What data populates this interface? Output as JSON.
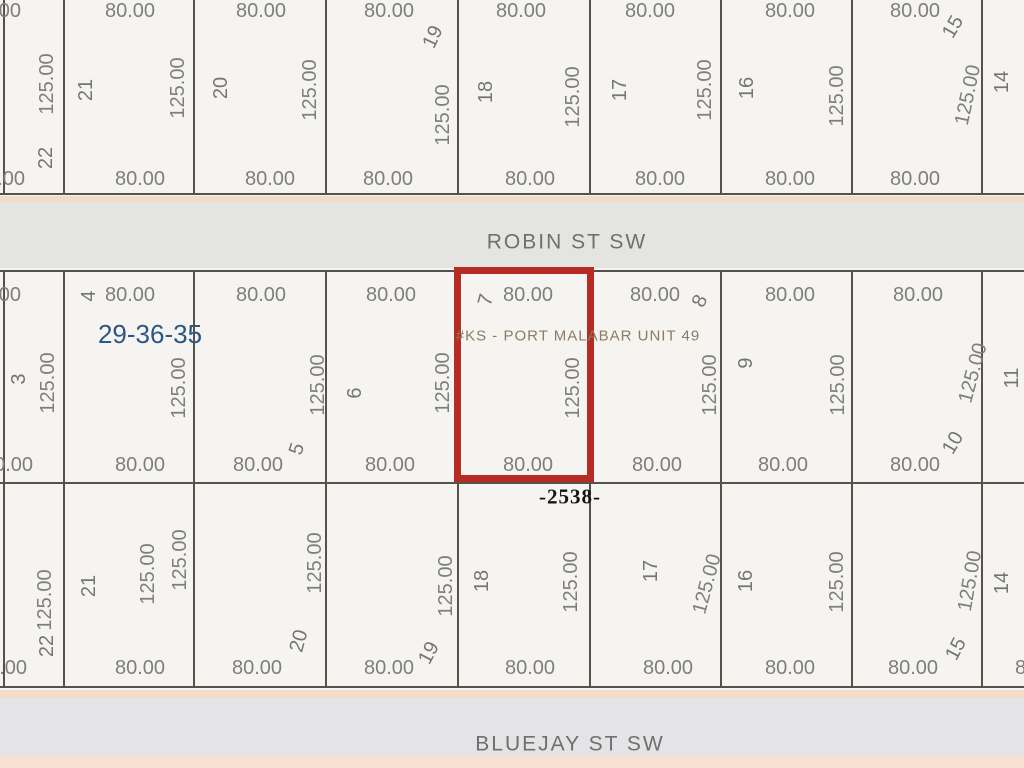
{
  "map": {
    "background": "#f5f4f1",
    "line_color": "#56514b",
    "highlight": {
      "parcel_lot": "7",
      "left": 454,
      "top": 267,
      "width": 140,
      "height": 215,
      "border_px": 7,
      "color": "#b62b24"
    },
    "bands": [
      {
        "y": 196,
        "h": 6,
        "color": "#f0dcc7"
      },
      {
        "y": 202,
        "h": 66,
        "color": "#e4e4e2"
      },
      {
        "y": 690,
        "h": 8,
        "color": "#f4ddc8"
      },
      {
        "y": 698,
        "h": 58,
        "color": "#e4e4e6"
      },
      {
        "y": 756,
        "h": 12,
        "color": "#f7e2d1"
      }
    ],
    "h_lines": [
      {
        "y": 194
      },
      {
        "y": 271
      },
      {
        "y": 483
      },
      {
        "y": 687
      }
    ],
    "grid_x": [
      4,
      64,
      194,
      326,
      458,
      590,
      721,
      852,
      982
    ],
    "blocks": [
      {
        "name": "north-block",
        "y1": 0,
        "y2": 194
      },
      {
        "name": "mid-block",
        "y1": 271,
        "y2": 483
      },
      {
        "name": "south-block",
        "y1": 483,
        "y2": 687
      }
    ],
    "streets": [
      {
        "name": "ROBIN ST SW"
      },
      {
        "name": "BLUEJAY ST SW"
      }
    ],
    "section_township_range": "29-36-35",
    "subdivision": "#KS - PORT MALABAR UNIT 49",
    "address_label": "-2538-",
    "labels": [
      {
        "t": "ROBIN ST SW",
        "x": 567,
        "y": 242,
        "r": 0,
        "c": "street",
        "n": "street-name-robin"
      },
      {
        "t": "BLUEJAY ST SW",
        "x": 570,
        "y": 744,
        "r": 0,
        "c": "street",
        "n": "street-name-bluejay"
      },
      {
        "t": "29-36-35",
        "x": 150,
        "y": 334,
        "r": 0,
        "c": "section",
        "n": "section-township-range-label"
      },
      {
        "t": "#KS - PORT MALABAR UNIT 49",
        "x": 578,
        "y": 336,
        "r": 0,
        "c": "unit",
        "n": "subdivision-label"
      },
      {
        "t": "-2538-",
        "x": 570,
        "y": 497,
        "r": 0,
        "c": "addr",
        "n": "address-label"
      },
      {
        "t": "80.00",
        "x": -4,
        "y": 11,
        "r": 0,
        "c": "dim"
      },
      {
        "t": "80.00",
        "x": 130,
        "y": 11,
        "r": 0,
        "c": "dim"
      },
      {
        "t": "80.00",
        "x": 261,
        "y": 11,
        "r": 0,
        "c": "dim"
      },
      {
        "t": "80.00",
        "x": 389,
        "y": 11,
        "r": 0,
        "c": "dim"
      },
      {
        "t": "80.00",
        "x": 521,
        "y": 11,
        "r": 0,
        "c": "dim"
      },
      {
        "t": "80.00",
        "x": 650,
        "y": 11,
        "r": 0,
        "c": "dim"
      },
      {
        "t": "80.00",
        "x": 790,
        "y": 11,
        "r": 0,
        "c": "dim"
      },
      {
        "t": "80.00",
        "x": 915,
        "y": 11,
        "r": 0,
        "c": "dim"
      },
      {
        "t": "80.00",
        "x": 0,
        "y": 179,
        "r": 0,
        "c": "dim"
      },
      {
        "t": "80.00",
        "x": 140,
        "y": 179,
        "r": 0,
        "c": "dim"
      },
      {
        "t": "80.00",
        "x": 270,
        "y": 179,
        "r": 0,
        "c": "dim"
      },
      {
        "t": "80.00",
        "x": 388,
        "y": 179,
        "r": 0,
        "c": "dim"
      },
      {
        "t": "80.00",
        "x": 530,
        "y": 179,
        "r": 0,
        "c": "dim"
      },
      {
        "t": "80.00",
        "x": 660,
        "y": 179,
        "r": 0,
        "c": "dim"
      },
      {
        "t": "80.00",
        "x": 790,
        "y": 179,
        "r": 0,
        "c": "dim"
      },
      {
        "t": "80.00",
        "x": 915,
        "y": 179,
        "r": 0,
        "c": "dim"
      },
      {
        "t": "125.00",
        "x": 47,
        "y": 84,
        "r": -90,
        "c": "dim"
      },
      {
        "t": "125.00",
        "x": 178,
        "y": 88,
        "r": -90,
        "c": "dim"
      },
      {
        "t": "125.00",
        "x": 310,
        "y": 90,
        "r": -90,
        "c": "dim"
      },
      {
        "t": "125.00",
        "x": 443,
        "y": 115,
        "r": -90,
        "c": "dim"
      },
      {
        "t": "125.00",
        "x": 573,
        "y": 97,
        "r": -90,
        "c": "dim"
      },
      {
        "t": "125.00",
        "x": 705,
        "y": 90,
        "r": -90,
        "c": "dim"
      },
      {
        "t": "125.00",
        "x": 837,
        "y": 96,
        "r": -90,
        "c": "dim"
      },
      {
        "t": "125.00",
        "x": 968,
        "y": 95,
        "r": -78,
        "c": "dim"
      },
      {
        "t": "22",
        "x": 46,
        "y": 158,
        "r": -90,
        "c": "lot"
      },
      {
        "t": "21",
        "x": 86,
        "y": 90,
        "r": -90,
        "c": "lot"
      },
      {
        "t": "20",
        "x": 221,
        "y": 88,
        "r": -90,
        "c": "lot"
      },
      {
        "t": "19",
        "x": 433,
        "y": 37,
        "r": -65,
        "c": "lot"
      },
      {
        "t": "18",
        "x": 486,
        "y": 92,
        "r": -90,
        "c": "lot"
      },
      {
        "t": "17",
        "x": 620,
        "y": 90,
        "r": -90,
        "c": "lot"
      },
      {
        "t": "16",
        "x": 747,
        "y": 88,
        "r": -90,
        "c": "lot"
      },
      {
        "t": "15",
        "x": 953,
        "y": 27,
        "r": -60,
        "c": "lot"
      },
      {
        "t": "14",
        "x": 1002,
        "y": 82,
        "r": -90,
        "c": "lot"
      },
      {
        "t": "80.00",
        "x": -4,
        "y": 295,
        "r": 0,
        "c": "dim"
      },
      {
        "t": "80.00",
        "x": 130,
        "y": 295,
        "r": 0,
        "c": "dim"
      },
      {
        "t": "80.00",
        "x": 261,
        "y": 295,
        "r": 0,
        "c": "dim"
      },
      {
        "t": "80.00",
        "x": 391,
        "y": 295,
        "r": 0,
        "c": "dim"
      },
      {
        "t": "80.00",
        "x": 528,
        "y": 295,
        "r": 0,
        "c": "dim"
      },
      {
        "t": "80.00",
        "x": 655,
        "y": 295,
        "r": 0,
        "c": "dim"
      },
      {
        "t": "80.00",
        "x": 790,
        "y": 295,
        "r": 0,
        "c": "dim"
      },
      {
        "t": "80.00",
        "x": 918,
        "y": 295,
        "r": 0,
        "c": "dim"
      },
      {
        "t": "80.00",
        "x": 8,
        "y": 465,
        "r": 0,
        "c": "dim"
      },
      {
        "t": "80.00",
        "x": 140,
        "y": 465,
        "r": 0,
        "c": "dim"
      },
      {
        "t": "80.00",
        "x": 258,
        "y": 465,
        "r": 0,
        "c": "dim"
      },
      {
        "t": "80.00",
        "x": 390,
        "y": 465,
        "r": 0,
        "c": "dim"
      },
      {
        "t": "80.00",
        "x": 528,
        "y": 465,
        "r": 0,
        "c": "dim"
      },
      {
        "t": "80.00",
        "x": 657,
        "y": 465,
        "r": 0,
        "c": "dim"
      },
      {
        "t": "80.00",
        "x": 783,
        "y": 465,
        "r": 0,
        "c": "dim"
      },
      {
        "t": "80.00",
        "x": 915,
        "y": 465,
        "r": 0,
        "c": "dim"
      },
      {
        "t": "125.00",
        "x": 48,
        "y": 383,
        "r": -90,
        "c": "dim"
      },
      {
        "t": "125.00",
        "x": 179,
        "y": 388,
        "r": -90,
        "c": "dim"
      },
      {
        "t": "125.00",
        "x": 318,
        "y": 385,
        "r": -90,
        "c": "dim"
      },
      {
        "t": "125.00",
        "x": 443,
        "y": 383,
        "r": -90,
        "c": "dim"
      },
      {
        "t": "125.00",
        "x": 573,
        "y": 388,
        "r": -90,
        "c": "dim"
      },
      {
        "t": "125.00",
        "x": 710,
        "y": 385,
        "r": -90,
        "c": "dim"
      },
      {
        "t": "125.00",
        "x": 838,
        "y": 385,
        "r": -90,
        "c": "dim"
      },
      {
        "t": "125.00",
        "x": 973,
        "y": 373,
        "r": -75,
        "c": "dim"
      },
      {
        "t": "3",
        "x": 19,
        "y": 379,
        "r": -90,
        "c": "lot"
      },
      {
        "t": "4",
        "x": 89,
        "y": 296,
        "r": -90,
        "c": "lot"
      },
      {
        "t": "5",
        "x": 297,
        "y": 449,
        "r": -72,
        "c": "lot"
      },
      {
        "t": "6",
        "x": 355,
        "y": 393,
        "r": -90,
        "c": "lot"
      },
      {
        "t": "7",
        "x": 486,
        "y": 300,
        "r": -75,
        "c": "lot"
      },
      {
        "t": "8",
        "x": 700,
        "y": 301,
        "r": -65,
        "c": "lot"
      },
      {
        "t": "9",
        "x": 746,
        "y": 363,
        "r": -90,
        "c": "lot"
      },
      {
        "t": "10",
        "x": 953,
        "y": 443,
        "r": -60,
        "c": "lot"
      },
      {
        "t": "11",
        "x": 1012,
        "y": 378,
        "r": -90,
        "c": "lot"
      },
      {
        "t": "80.00",
        "x": 2,
        "y": 668,
        "r": 0,
        "c": "dim"
      },
      {
        "t": "80.00",
        "x": 140,
        "y": 668,
        "r": 0,
        "c": "dim"
      },
      {
        "t": "80.00",
        "x": 257,
        "y": 668,
        "r": 0,
        "c": "dim"
      },
      {
        "t": "80.00",
        "x": 389,
        "y": 668,
        "r": 0,
        "c": "dim"
      },
      {
        "t": "80.00",
        "x": 530,
        "y": 668,
        "r": 0,
        "c": "dim"
      },
      {
        "t": "80.00",
        "x": 668,
        "y": 668,
        "r": 0,
        "c": "dim"
      },
      {
        "t": "80.00",
        "x": 790,
        "y": 668,
        "r": 0,
        "c": "dim"
      },
      {
        "t": "80.00",
        "x": 913,
        "y": 668,
        "r": 0,
        "c": "dim"
      },
      {
        "t": "80.00",
        "x": 1040,
        "y": 668,
        "r": 0,
        "c": "dim"
      },
      {
        "t": "125.00",
        "x": 45,
        "y": 600,
        "r": -90,
        "c": "dim"
      },
      {
        "t": "125.00",
        "x": 148,
        "y": 574,
        "r": -90,
        "c": "dim"
      },
      {
        "t": "125.00",
        "x": 180,
        "y": 560,
        "r": -90,
        "c": "dim"
      },
      {
        "t": "125.00",
        "x": 315,
        "y": 563,
        "r": -90,
        "c": "dim"
      },
      {
        "t": "125.00",
        "x": 446,
        "y": 586,
        "r": -90,
        "c": "dim"
      },
      {
        "t": "125.00",
        "x": 571,
        "y": 582,
        "r": -90,
        "c": "dim"
      },
      {
        "t": "125.00",
        "x": 707,
        "y": 584,
        "r": -75,
        "c": "dim"
      },
      {
        "t": "125.00",
        "x": 837,
        "y": 582,
        "r": -90,
        "c": "dim"
      },
      {
        "t": "125.00",
        "x": 970,
        "y": 581,
        "r": -80,
        "c": "dim"
      },
      {
        "t": "22",
        "x": 47,
        "y": 646,
        "r": -90,
        "c": "lot"
      },
      {
        "t": "21",
        "x": 89,
        "y": 586,
        "r": -90,
        "c": "lot"
      },
      {
        "t": "20",
        "x": 299,
        "y": 641,
        "r": -75,
        "c": "lot"
      },
      {
        "t": "19",
        "x": 429,
        "y": 653,
        "r": -62,
        "c": "lot"
      },
      {
        "t": "18",
        "x": 482,
        "y": 581,
        "r": -90,
        "c": "lot"
      },
      {
        "t": "17",
        "x": 651,
        "y": 571,
        "r": -90,
        "c": "lot"
      },
      {
        "t": "16",
        "x": 746,
        "y": 581,
        "r": -90,
        "c": "lot"
      },
      {
        "t": "15",
        "x": 956,
        "y": 649,
        "r": -62,
        "c": "lot"
      },
      {
        "t": "14",
        "x": 1002,
        "y": 583,
        "r": -90,
        "c": "lot"
      }
    ]
  }
}
